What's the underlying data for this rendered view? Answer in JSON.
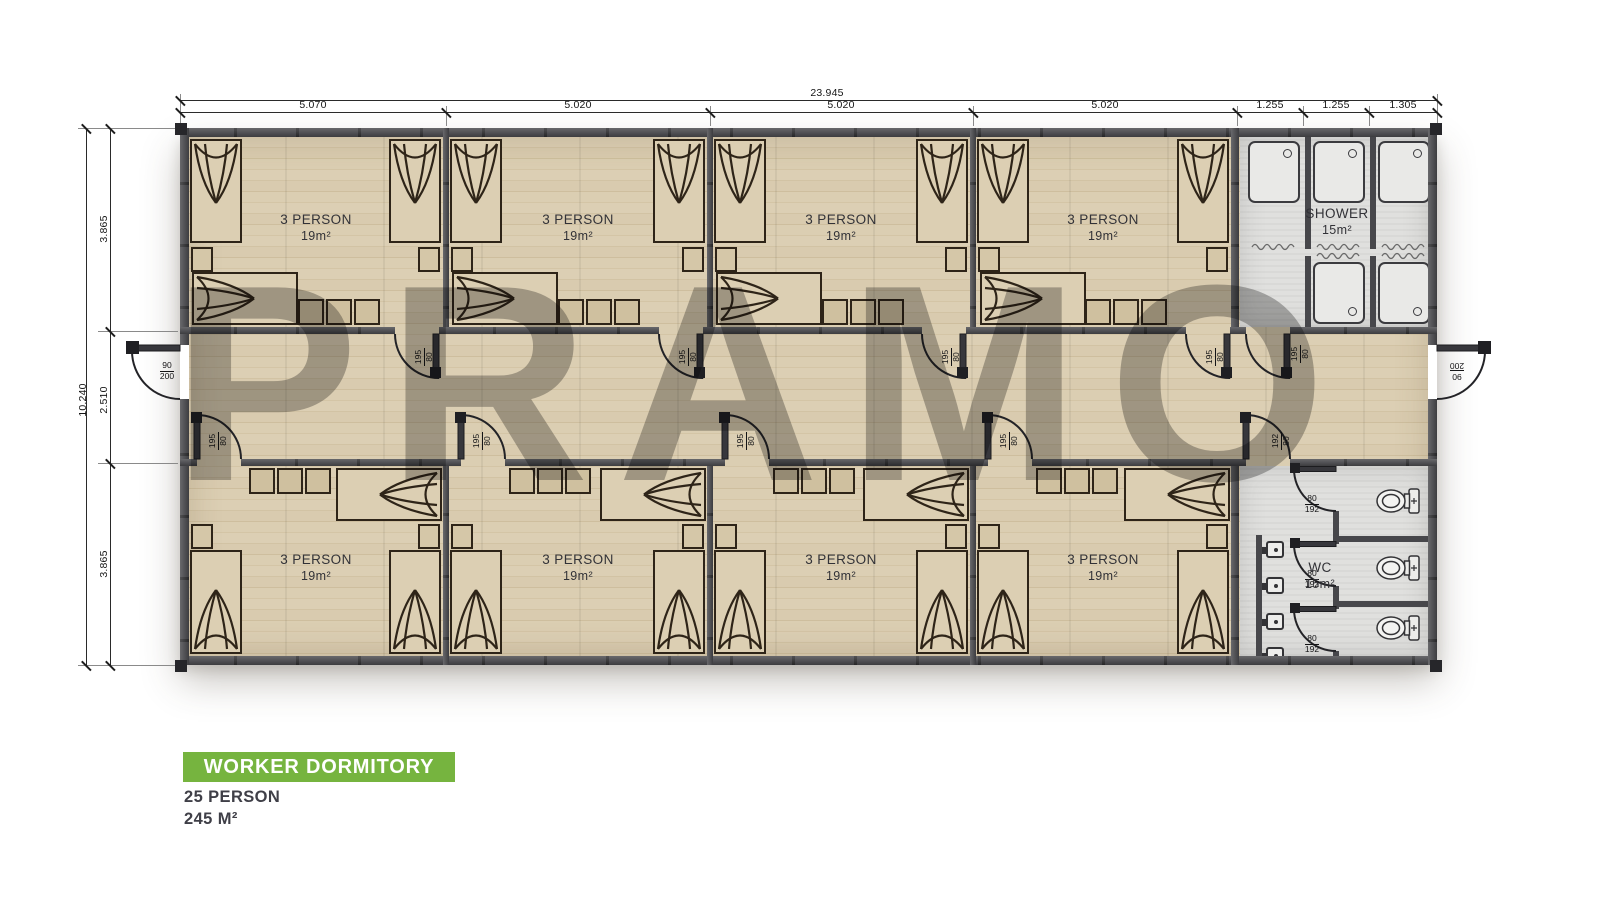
{
  "watermark": "PRAMO",
  "title": {
    "banner": "WORKER DORMITORY",
    "capacity": "25 PERSON",
    "area": "245 M²"
  },
  "rooms": [
    {
      "label": "3 PERSON",
      "area": "19m²"
    },
    {
      "label": "3 PERSON",
      "area": "19m²"
    },
    {
      "label": "3 PERSON",
      "area": "19m²"
    },
    {
      "label": "3 PERSON",
      "area": "19m²"
    },
    {
      "label": "3 PERSON",
      "area": "19m²"
    },
    {
      "label": "3 PERSON",
      "area": "19m²"
    },
    {
      "label": "3 PERSON",
      "area": "19m²"
    },
    {
      "label": "3 PERSON",
      "area": "19m²"
    }
  ],
  "shower": {
    "label": "SHOWER",
    "area": "15m²"
  },
  "wc": {
    "label": "WC",
    "area": "15m²"
  },
  "dims": {
    "top_total": "23.945",
    "top_segments": [
      "5.070",
      "5.020",
      "5.020",
      "5.020",
      "1.255",
      "1.255",
      "1.305"
    ],
    "left_total": "10.240",
    "left_segments": [
      "3.865",
      "2.510",
      "3.865"
    ]
  },
  "doors": {
    "exterior": {
      "num": "90",
      "den": "200"
    },
    "room": {
      "num": "195",
      "den": "80"
    },
    "shower_entry": {
      "num": "195",
      "den": "80"
    },
    "wc_entry": {
      "num": "192",
      "den": "80"
    },
    "stall": {
      "num": "80",
      "den": "192"
    }
  },
  "colors": {
    "accent_green": "#76b43f",
    "wall": "#47474b",
    "wood": "#d8caae",
    "tile": "#e0e0de",
    "watermark": "#6f6f6f"
  }
}
